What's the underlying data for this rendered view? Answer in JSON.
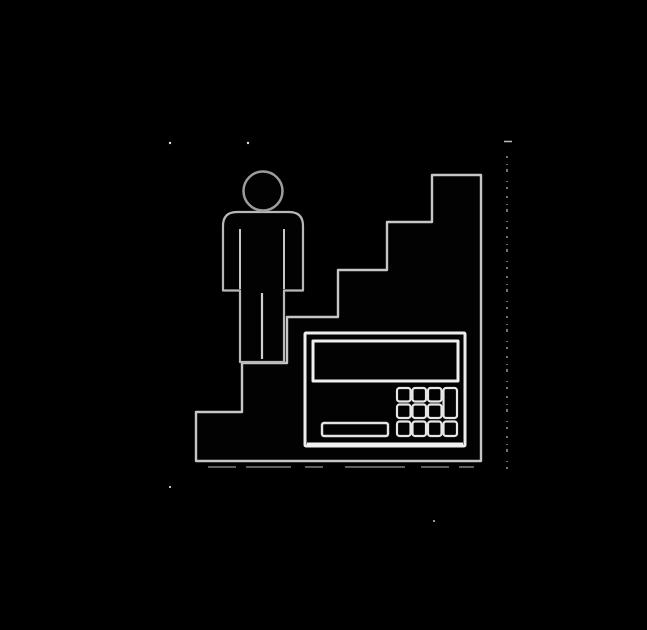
{
  "meta": {
    "title": "Person on staircase with cash register pictogram",
    "description": "Monochrome scanned pictogram: a restroom-style human figure stands on the upper-left step of a descending staircase silhouette; a cash register / calculator with display, keypad and drawer bar is inset into the staircase base; faint scanner noise specks and a dotted vertical artifact line appear around the art.",
    "canvas": {
      "width": 647,
      "height": 630
    }
  },
  "palette": {
    "background": "#000000",
    "ink_fill": "#020202",
    "outline_bright": "#efefef",
    "outline_mid": "#c6c6c6",
    "outline_dim": "#9c9c9c"
  },
  "shapes": [
    {
      "name": "background",
      "type": "rect",
      "x": 0,
      "y": 0,
      "w": 647,
      "h": 630,
      "fill": "#000000"
    },
    {
      "name": "staircase-silhouette",
      "type": "polygon",
      "points": "196,461 196,412 242,412 242,363 287,363 287,317 338,317 338,270 387,270 387,222 432,222 432,175 481,175 481,461",
      "fill": "#020202",
      "stroke": "#c6c6c6",
      "strokeWidth": 2.4
    },
    {
      "name": "person-body",
      "type": "path",
      "d": "M 240 362 L 240 290.5 L 223 290.5 L 223 226 Q 223 212 237 212 L 289 212 Q 303 212 303 226 L 303 290.5 L 284 290.5 L 284 362 Z",
      "fill": "#020202",
      "stroke": "#b8b8b8",
      "strokeWidth": 2.2
    },
    {
      "name": "person-head",
      "type": "circle",
      "cx": 263,
      "cy": 191,
      "r": 19.5,
      "fill": "#020202",
      "stroke": "#9c9c9c",
      "strokeWidth": 2.5
    },
    {
      "name": "person-left-arm-crease",
      "type": "line",
      "x1": 240,
      "y1": 229,
      "x2": 240,
      "y2": 289,
      "stroke": "#c8c8c8",
      "strokeWidth": 2
    },
    {
      "name": "person-right-arm-crease",
      "type": "line",
      "x1": 284,
      "y1": 229,
      "x2": 284,
      "y2": 289,
      "stroke": "#c8c8c8",
      "strokeWidth": 2
    },
    {
      "name": "person-leg-separator",
      "type": "line",
      "x1": 262,
      "y1": 293,
      "x2": 262,
      "y2": 359,
      "stroke": "#cfcfcf",
      "strokeWidth": 2.2
    },
    {
      "name": "register-body",
      "type": "rect",
      "x": 305,
      "y": 333,
      "w": 160,
      "h": 113,
      "rx": 1,
      "fill": "#020202",
      "stroke": "#ededed",
      "strokeWidth": 3
    },
    {
      "name": "register-base-highlight",
      "type": "line",
      "x1": 307,
      "y1": 444.5,
      "x2": 463,
      "y2": 444.5,
      "stroke": "#f2f2f2",
      "strokeWidth": 4
    },
    {
      "name": "register-display",
      "type": "rect",
      "x": 313,
      "y": 341,
      "w": 145,
      "h": 40,
      "fill": "#020202",
      "stroke": "#efefef",
      "strokeWidth": 3
    },
    {
      "name": "register-drawer-bar",
      "type": "rect",
      "x": 322,
      "y": 423,
      "w": 66,
      "h": 13,
      "rx": 2,
      "fill": "#020202",
      "stroke": "#e4e4e4",
      "strokeWidth": 2.4
    },
    {
      "name": "register-key-r1c1",
      "type": "rect",
      "x": 397,
      "y": 388,
      "w": 13.5,
      "h": 13.5,
      "rx": 2.5,
      "fill": "#020202",
      "stroke": "#e6e6e6",
      "strokeWidth": 2.2
    },
    {
      "name": "register-key-r1c2",
      "type": "rect",
      "x": 412.5,
      "y": 388,
      "w": 13.5,
      "h": 13.5,
      "rx": 2.5,
      "fill": "#020202",
      "stroke": "#e6e6e6",
      "strokeWidth": 2.2
    },
    {
      "name": "register-key-r1c3",
      "type": "rect",
      "x": 428,
      "y": 388,
      "w": 13.5,
      "h": 13.5,
      "rx": 2.5,
      "fill": "#020202",
      "stroke": "#e6e6e6",
      "strokeWidth": 2.2
    },
    {
      "name": "register-key-r2c1",
      "type": "rect",
      "x": 397,
      "y": 404.5,
      "w": 13.5,
      "h": 13.5,
      "rx": 2.5,
      "fill": "#020202",
      "stroke": "#e6e6e6",
      "strokeWidth": 2.2
    },
    {
      "name": "register-key-r2c2",
      "type": "rect",
      "x": 412.5,
      "y": 404.5,
      "w": 13.5,
      "h": 13.5,
      "rx": 2.5,
      "fill": "#020202",
      "stroke": "#e6e6e6",
      "strokeWidth": 2.2
    },
    {
      "name": "register-key-r2c3",
      "type": "rect",
      "x": 428,
      "y": 404.5,
      "w": 13.5,
      "h": 13.5,
      "rx": 2.5,
      "fill": "#020202",
      "stroke": "#e6e6e6",
      "strokeWidth": 2.2
    },
    {
      "name": "register-key-r3c1",
      "type": "rect",
      "x": 397,
      "y": 421.5,
      "w": 13.5,
      "h": 14.5,
      "rx": 2.5,
      "fill": "#020202",
      "stroke": "#e6e6e6",
      "strokeWidth": 2.2
    },
    {
      "name": "register-key-r3c2",
      "type": "rect",
      "x": 412.5,
      "y": 421.5,
      "w": 13.5,
      "h": 14.5,
      "rx": 2.5,
      "fill": "#020202",
      "stroke": "#e6e6e6",
      "strokeWidth": 2.2
    },
    {
      "name": "register-key-r3c3",
      "type": "rect",
      "x": 428,
      "y": 421.5,
      "w": 13.5,
      "h": 14.5,
      "rx": 2.5,
      "fill": "#020202",
      "stroke": "#e6e6e6",
      "strokeWidth": 2.2
    },
    {
      "name": "register-key-tall",
      "type": "rect",
      "x": 443.5,
      "y": 388,
      "w": 13.5,
      "h": 30,
      "rx": 2.5,
      "fill": "#020202",
      "stroke": "#e6e6e6",
      "strokeWidth": 2.2
    },
    {
      "name": "register-key-r3c4",
      "type": "rect",
      "x": 443.5,
      "y": 421.5,
      "w": 13.5,
      "h": 14.5,
      "rx": 2.5,
      "fill": "#020202",
      "stroke": "#e6e6e6",
      "strokeWidth": 2.2
    },
    {
      "name": "scan-artifact-line",
      "type": "line",
      "x1": 507,
      "y1": 156,
      "x2": 507,
      "y2": 474,
      "stroke": "#cdcdcd",
      "strokeWidth": 1.3,
      "dash": "2 6 1 4 3 9 1 5 2 7",
      "opacity": 0.85
    },
    {
      "name": "scan-artifact-dash",
      "type": "line",
      "x1": 504,
      "y1": 141.5,
      "x2": 512,
      "y2": 141.5,
      "stroke": "#d0d0d0",
      "strokeWidth": 1.5,
      "opacity": 0.9
    },
    {
      "name": "scan-artifact-underline",
      "type": "line",
      "x1": 208,
      "y1": 467,
      "x2": 474,
      "y2": 467,
      "stroke": "#9f9f9f",
      "strokeWidth": 1.4,
      "dash": "28 10 45 14 18 22 60 16",
      "opacity": 0.8
    },
    {
      "name": "scan-speck-1",
      "type": "circle",
      "cx": 170,
      "cy": 143,
      "r": 1.2,
      "fill": "#e0e0e0"
    },
    {
      "name": "scan-speck-2",
      "type": "circle",
      "cx": 248,
      "cy": 143,
      "r": 1.2,
      "fill": "#e0e0e0"
    },
    {
      "name": "scan-speck-3",
      "type": "circle",
      "cx": 170,
      "cy": 487,
      "r": 1.1,
      "fill": "#d5d5d5"
    },
    {
      "name": "scan-speck-4",
      "type": "circle",
      "cx": 434,
      "cy": 521,
      "r": 1.0,
      "fill": "#c9c9c9"
    }
  ]
}
